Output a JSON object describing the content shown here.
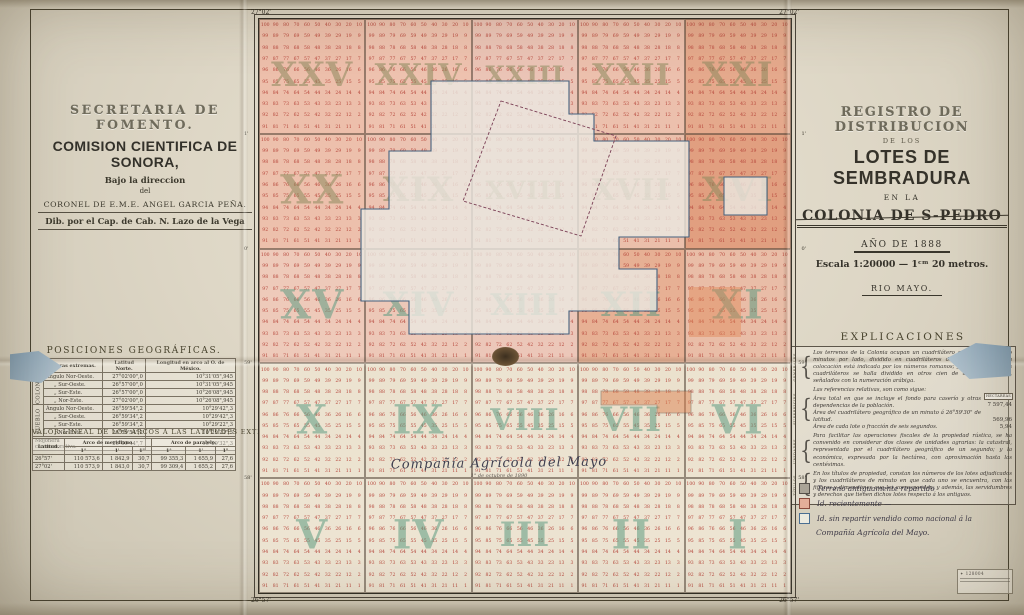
{
  "left_panel": {
    "agency": "SECRETARIA DE FOMENTO.",
    "commission": "COMISION CIENTIFICA DE SONORA,",
    "direction_line1": "Bajo la direccion",
    "direction_line2": "del",
    "director": "CORONEL DE E.M.E. ANGEL GARCIA PEÑA.",
    "draftsman": "Dib. por el Cap. de Cab. N. Lazo de la Vega",
    "posiciones": {
      "title": "POSICIONES GEOGRÁFICAS.",
      "col_headers": [
        "Mojoneras extremas.",
        "Latitud Norte.",
        "Longitud en arco al O. de México."
      ],
      "rows": [
        {
          "group": "COLONIA",
          "name": "Ángulo Nor-Oeste.",
          "lat": "27°02'00\",0",
          "lon": "10°31'05\",945"
        },
        {
          "name": "„  Sur-Oeste.",
          "lat": "26°57'00\",0",
          "lon": "10°31'05\",945"
        },
        {
          "name": "„  Sur-Este.",
          "lat": "26°57'00\",0",
          "lon": "10°26'08\",945"
        },
        {
          "name": "„  Nor-Este.",
          "lat": "27°02'00\",0",
          "lon": "10°26'08\",945"
        },
        {
          "group": "PUEBLO",
          "name": "Ángulo Nor-Oeste.",
          "lat": "26°59'54\",2",
          "lon": "10°29'42\",3"
        },
        {
          "name": "„  Sur-Oeste.",
          "lat": "26°59'34\",2",
          "lon": "10°29'42\",3"
        },
        {
          "name": "„  Sur-Este.",
          "lat": "26°59'34\",2",
          "lon": "10°29'22\",3"
        },
        {
          "name": "„  Nor-Este.",
          "lat": "26°59'54\",2",
          "lon": "10°29'22\",3"
        }
      ],
      "footer": {
        "name": "Mojonera conmemorativa.",
        "lat": "26°59'44\",7",
        "lon": "10°29'32\",3"
      }
    },
    "valor_lineal": {
      "title": "VALOR LINEAL DE LOS ARCOS Á LAS LATITUDES EXTREMAS.",
      "group_headers": [
        "Latitud.",
        "Arco de meridiano.",
        "Arco de paralelo."
      ],
      "sub_headers": [
        "1°",
        "1'",
        "1\"",
        "1°",
        "1'",
        "1\""
      ],
      "rows": [
        [
          "26°57'",
          "110 573,6",
          "1 842,9",
          "30,7",
          "99 355,3",
          "1 655,9",
          "27,6"
        ],
        [
          "27°02'",
          "110 573,9",
          "1 843,0",
          "30,7",
          "99 309,4",
          "1 655,2",
          "27,6"
        ]
      ]
    }
  },
  "right_panel": {
    "title1": "REGISTRO DE DISTRIBUCION",
    "title2": "DE LOS",
    "title3": "LOTES DE SEMBRADURA",
    "title4": "EN LA",
    "title5": "COLONIA DE S-PEDRO",
    "title6": "AÑO DE 1888",
    "scale": "Escala 1:20000 — 1ᶜᵐ 20 metros.",
    "river": "RIO MAYO.",
    "explicaciones": {
      "title": "EXPLICACIONES",
      "sections": [
        {
          "label": "GENERALES",
          "text": "Los terrenos de la Colonia ocupan un cuadrilátero geográfico de cinco minutos por lado, dividido en cuadriláteros de á un minuto, cuya colocación está indicada por los números romanos; y cada uno de estos cuadriláteros se halla dividido en otros cien de á seis segundos, señalados con la numeración arábiga."
        },
        {
          "label": "SUPERFICIES",
          "intro": "Las referencias relativas, son como sigue:",
          "units_header": "HECTÁREAS",
          "items": [
            {
              "text": "Área total en que se incluye el fondo para caserío y otras dependencias de la población.",
              "value": "7 597,44"
            },
            {
              "text": "Área del cuadrilátero geográfico de un minuto á 26°59'30\" de latitud.",
              "value": "569,96"
            },
            {
              "text": "Área de cada lote o fracción de seis segundos.",
              "value": "5,94"
            }
          ]
        },
        {
          "label": "UNIDADES",
          "text": "Para facilitar las operaciones fiscales de la propiedad rústica, se ha convenido en considerar dos clases de unidades agrarias: la catastral, representada por el cuadrilátero geográfico de un segundo; y la económica, expresada por la hectárea, con aproximación hasta las centésimas."
        },
        {
          "label": "TÍTULOS",
          "text": "En los títulos de propiedad, constan los números de los lotes adjudicados y los cuadriláteros de minuto en que cada uno se encuentra, con las figuras y dimensiones que les corresponden; y además, las servidumbres y derechos que tienen dichos lotes respecto á los antiguos."
        }
      ]
    },
    "legend": {
      "items": [
        {
          "color": "#a9a396",
          "border": "#55504a",
          "label": "Terreno antiguamente repartido"
        },
        {
          "color": "#e4ae99",
          "border": "#8a4a3c",
          "label": "Id.  recientemente  —"
        },
        {
          "color": "#eceadf",
          "border": "#4a6e92",
          "label": "Id.  sin repartir vendido como nacional á la"
        }
      ],
      "footnote": "Compañía Agrícola del Mayo."
    },
    "stamp_number": "128004"
  },
  "map": {
    "corner_labels": {
      "top_left": "27°02'",
      "top_right": "27°02'",
      "bottom_left": "26°57'",
      "bottom_right": "26°57'"
    },
    "edge_minute_labels": [
      "1'",
      "0'",
      "59'",
      "58'"
    ],
    "blocks": [
      "XXV",
      "XXIV",
      "XXIII",
      "XXII",
      "XXI",
      "XX",
      "XIX",
      "XVIII",
      "XVII",
      "XVI",
      "XV",
      "XIV",
      "XIII",
      "XII",
      "XI",
      "X",
      "IX",
      "VIII",
      "VII",
      "VI",
      "V",
      "IV",
      "III",
      "II",
      "I"
    ],
    "block_colors": [
      "#edbfab",
      "#eec2af",
      "#ebc4b6",
      "#ecc0ad",
      "#e5a98c",
      "#edc0ac",
      "#ecc3b2",
      "#eac6b8",
      "#ebbfab",
      "#e19f80",
      "#eecaba",
      "#edc8b8",
      "#ecc7b9",
      "#e7b094",
      "#e9bda7",
      "#ece3d0",
      "#ebe2cf",
      "#ece3d1",
      "#ebe1cd",
      "#ece3d0",
      "#ede4d2",
      "#ede4d2",
      "#ece3d1",
      "#ede4d2",
      "#ede4d2"
    ],
    "numeral_colors": {
      "upper_rows": "#8d8a5e",
      "lower_rows": "#5f9c82"
    },
    "cell_number_color": "#b5453a",
    "cell_values": [
      [
        100,
        90,
        80,
        70,
        60,
        50,
        40,
        30,
        20,
        10
      ],
      [
        99,
        89,
        79,
        69,
        59,
        49,
        39,
        29,
        19,
        9
      ],
      [
        98,
        88,
        78,
        68,
        58,
        48,
        38,
        28,
        18,
        8
      ],
      [
        97,
        87,
        77,
        67,
        57,
        47,
        37,
        27,
        17,
        7
      ],
      [
        96,
        86,
        76,
        66,
        56,
        46,
        36,
        26,
        16,
        6
      ],
      [
        95,
        85,
        75,
        65,
        55,
        45,
        35,
        25,
        15,
        5
      ],
      [
        94,
        84,
        74,
        64,
        54,
        44,
        34,
        24,
        14,
        4
      ],
      [
        93,
        83,
        73,
        63,
        53,
        43,
        33,
        23,
        13,
        3
      ],
      [
        92,
        82,
        72,
        62,
        52,
        42,
        32,
        22,
        12,
        2
      ],
      [
        91,
        81,
        71,
        61,
        51,
        41,
        31,
        21,
        11,
        1
      ]
    ],
    "center_label": "Compañía  Agrícola  del  Mayo",
    "center_sublabel": "1° de octubre de 1890"
  }
}
